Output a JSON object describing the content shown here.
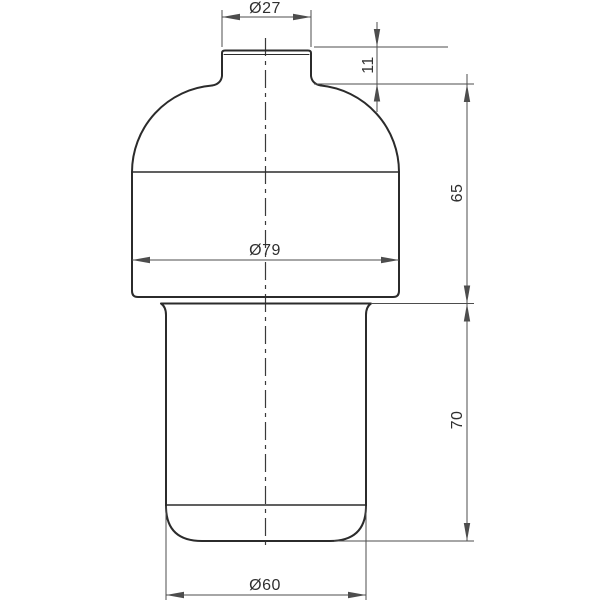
{
  "drawing": {
    "labels": {
      "neck_diameter": "Ø27",
      "neck_height": "11",
      "upper_body_height": "65",
      "body_diameter": "Ø79",
      "lower_body_height": "70",
      "bottom_diameter": "Ø60"
    },
    "colors": {
      "background": "#ffffff",
      "outline": "#2b2b2b",
      "dimension": "#4d4d4d",
      "centerline": "#3a3a3a",
      "text": "#2f2f2f"
    }
  }
}
